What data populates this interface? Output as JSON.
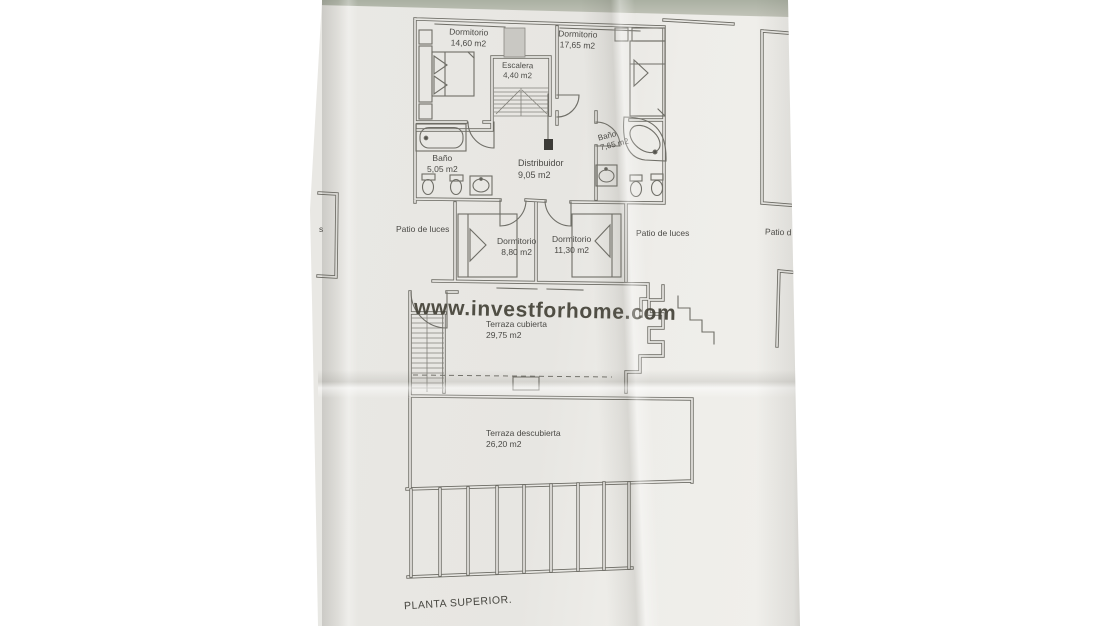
{
  "photo": {
    "watermark": "www.investforhome.com",
    "plan_title": "PLANTA SUPERIOR.",
    "colors": {
      "background": "#ffffff",
      "paper": "#e8e7e3",
      "plan_line": "#6b6a63",
      "label_text": "#4b4a46",
      "watermark_text": "#454339",
      "top_edge_strip": "#b3b6ab"
    },
    "rooms": [
      {
        "id": "dormitorio-1",
        "name": "Dormitorio",
        "area": "14,60 m2"
      },
      {
        "id": "dormitorio-2",
        "name": "Dormitorio",
        "area": "17,65 m2"
      },
      {
        "id": "escalera",
        "name": "Escalera",
        "area": "4,40 m2"
      },
      {
        "id": "bano-1",
        "name": "Baño",
        "area": "5,05 m2"
      },
      {
        "id": "distribuidor",
        "name": "Distribuidor",
        "area": "9,05 m2"
      },
      {
        "id": "bano-2",
        "name": "Baño",
        "area": "7,65 m2"
      },
      {
        "id": "dormitorio-3",
        "name": "Dormitorio",
        "area": "8,80 m2"
      },
      {
        "id": "dormitorio-4",
        "name": "Dormitorio",
        "area": "11,30 m2"
      },
      {
        "id": "terraza-cubierta",
        "name": "Terraza cubierta",
        "area": "29,75 m2"
      },
      {
        "id": "terraza-descubierta",
        "name": "Terraza descubierta",
        "area": "26,20 m2"
      }
    ],
    "patios": {
      "left": "Patio de luces",
      "right": "Patio de luces",
      "far_right_partial": "Patio d",
      "left_edge_partial": "s"
    }
  }
}
